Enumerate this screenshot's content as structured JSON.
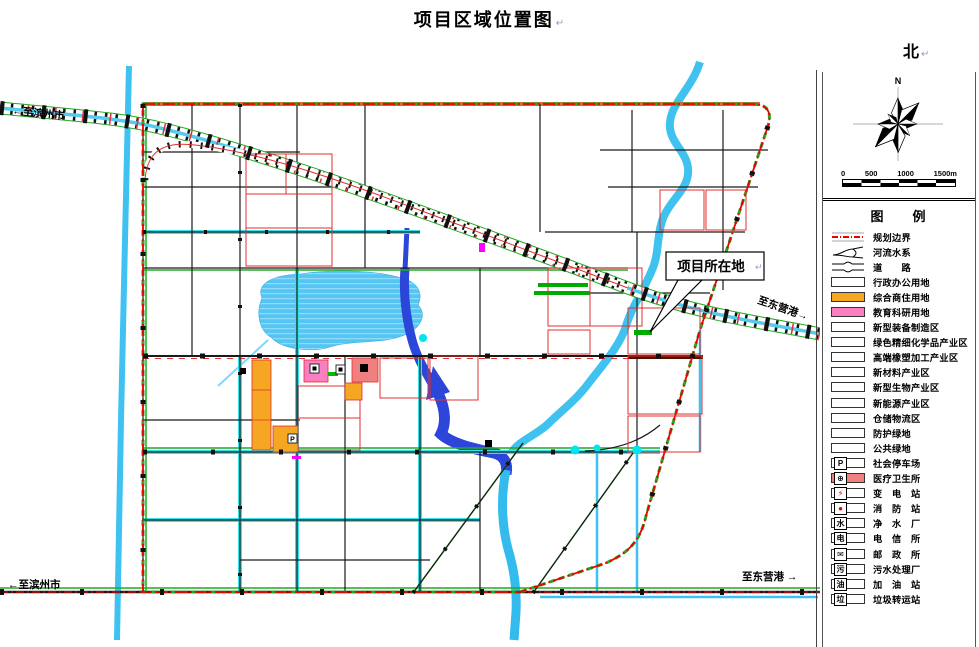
{
  "title": "项目区域位置图",
  "paragraph_mark": "↵",
  "north_label": "北",
  "compass": {
    "north": "N"
  },
  "scale_bar": {
    "ticks": [
      "0",
      "500",
      "1000",
      "1500m"
    ]
  },
  "legend": {
    "title": "图　例",
    "items": [
      {
        "label": "规划边界",
        "type": "boundary-line"
      },
      {
        "label": "河流水系",
        "type": "river-symbol"
      },
      {
        "label": "道　　路",
        "type": "road-symbol"
      },
      {
        "label": "行政办公用地",
        "color": "#FFFFFF"
      },
      {
        "label": "综合商住用地",
        "color": "#F5A623"
      },
      {
        "label": "教育科研用地",
        "color": "#FB7EC1"
      },
      {
        "label": "新型装备制造区",
        "color": "#FFFFFF"
      },
      {
        "label": "绿色精细化学品产业区",
        "color": "#FFFFFF"
      },
      {
        "label": "高端橡塑加工产业区",
        "color": "#FFFFFF"
      },
      {
        "label": "新材料产业区",
        "color": "#FFFFFF"
      },
      {
        "label": "新型生物产业区",
        "color": "#FFFFFF"
      },
      {
        "label": "新能源产业区",
        "color": "#FFFFFF"
      },
      {
        "label": "仓储物流区",
        "color": "#FFFFFF"
      },
      {
        "label": "防护绿地",
        "color": "#FFFFFF"
      },
      {
        "label": "公共绿地",
        "color": "#FFFFFF"
      },
      {
        "label": "社会停车场",
        "color": "#FFFFFF",
        "glyph": "P"
      },
      {
        "label": "医疗卫生所",
        "color": "#F08080",
        "glyph": "⊕"
      },
      {
        "label": "变　电　站",
        "color": "#FFFFFF",
        "glyph": "⚡",
        "glyph_color": "#C00000"
      },
      {
        "label": "消　防　站",
        "color": "#FFFFFF",
        "glyph": "●",
        "glyph_color": "#DD0000"
      },
      {
        "label": "净　水　厂",
        "color": "#FFFFFF",
        "glyph": "水"
      },
      {
        "label": "电　信　所",
        "color": "#FFFFFF",
        "glyph": "电"
      },
      {
        "label": "邮　政　所",
        "color": "#FFFFFF",
        "glyph": "✉"
      },
      {
        "label": "污水处理厂",
        "color": "#FFFFFF",
        "glyph": "污"
      },
      {
        "label": "加　油　站",
        "color": "#FFFFFF",
        "glyph": "油"
      },
      {
        "label": "垃圾转运站",
        "color": "#FFFFFF",
        "glyph": "垃"
      }
    ]
  },
  "map": {
    "callout": {
      "label": "项目所在地"
    },
    "road_labels": {
      "to_binzhou_top": "←至滨州市",
      "to_binzhou_bottom": "←至滨州市",
      "to_dongying_diag": "至东营港→",
      "to_dongying_bottom": "至东营港 →"
    },
    "colors": {
      "boundary_red": "#EE0000",
      "green_edge": "#22AA22",
      "river_cyan": "#3FC2F0",
      "river_deep_blue": "#2B46D9",
      "lake_blue": "#56C5F4",
      "parcel_red": "#E03030",
      "commercial_orange": "#F5A623",
      "education_pink": "#FB7EC1",
      "medical_salmon": "#F08080"
    }
  }
}
